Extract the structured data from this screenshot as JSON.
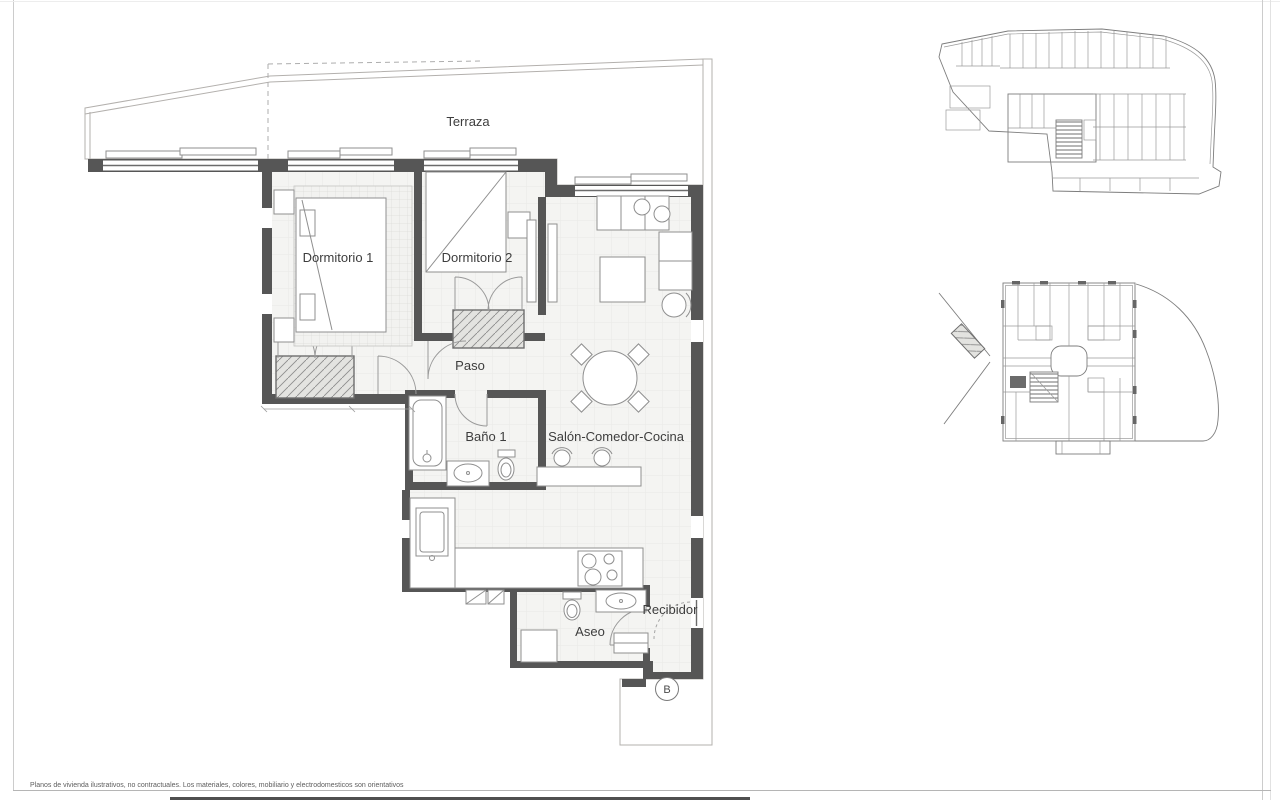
{
  "document": {
    "disclaimer": "Planos de vivienda ilustrativos, no contractuales. Los materiales, colores, mobiliario y electrodomesticos son orientativos"
  },
  "floor_plan": {
    "rooms": {
      "terraza": "Terraza",
      "dormitorio_1": "Dormitorio 1",
      "dormitorio_2": "Dormitorio 2",
      "paso": "Paso",
      "bano_1": "Baño 1",
      "salon_comedor_cocina": "Salón-Comedor-Cocina",
      "aseo": "Aseo",
      "recibidor": "Recibidor"
    },
    "unit_label": "B"
  },
  "colors": {
    "wall": "#565656",
    "line": "#8f8f8f",
    "label": "#3d3d3d",
    "grid": "#e7e7e4",
    "terrace_grid": "#dddbd8"
  }
}
